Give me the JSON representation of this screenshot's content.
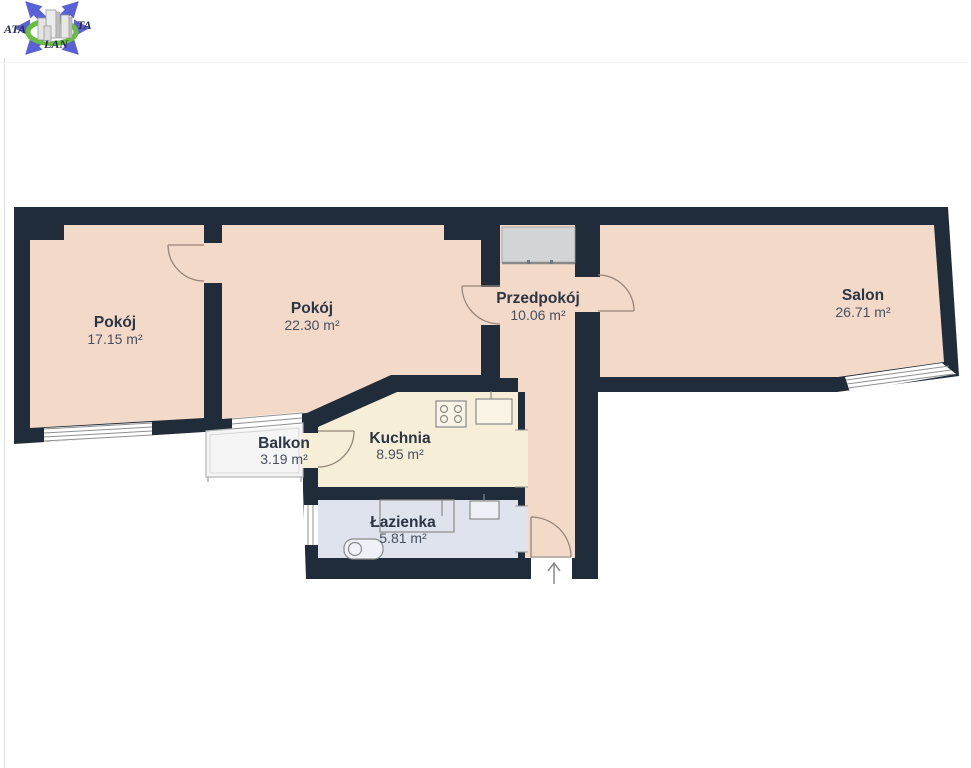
{
  "logo": {
    "part_left": "ATA",
    "part_right": "TA",
    "part_bottom": "LAN"
  },
  "plan": {
    "rooms": [
      {
        "name": "Pokój",
        "area": "17.15 m²"
      },
      {
        "name": "Pokój",
        "area": "22.30 m²"
      },
      {
        "name": "Przedpokój",
        "area": "10.06 m²"
      },
      {
        "name": "Salon",
        "area": "26.71 m²"
      },
      {
        "name": "Balkon",
        "area": "3.19 m²"
      },
      {
        "name": "Kuchnia",
        "area": "8.95 m²"
      },
      {
        "name": "Łazienka",
        "area": "5.81 m²"
      }
    ],
    "colors": {
      "wall": "#212c3a",
      "room_floor": "#f3d9c8",
      "kitchen_floor": "#f6eed7",
      "bathroom_floor": "#dfe3ee",
      "balcony_floor": "#f5f5f5",
      "wardrobe": "#d3d4d6"
    }
  }
}
